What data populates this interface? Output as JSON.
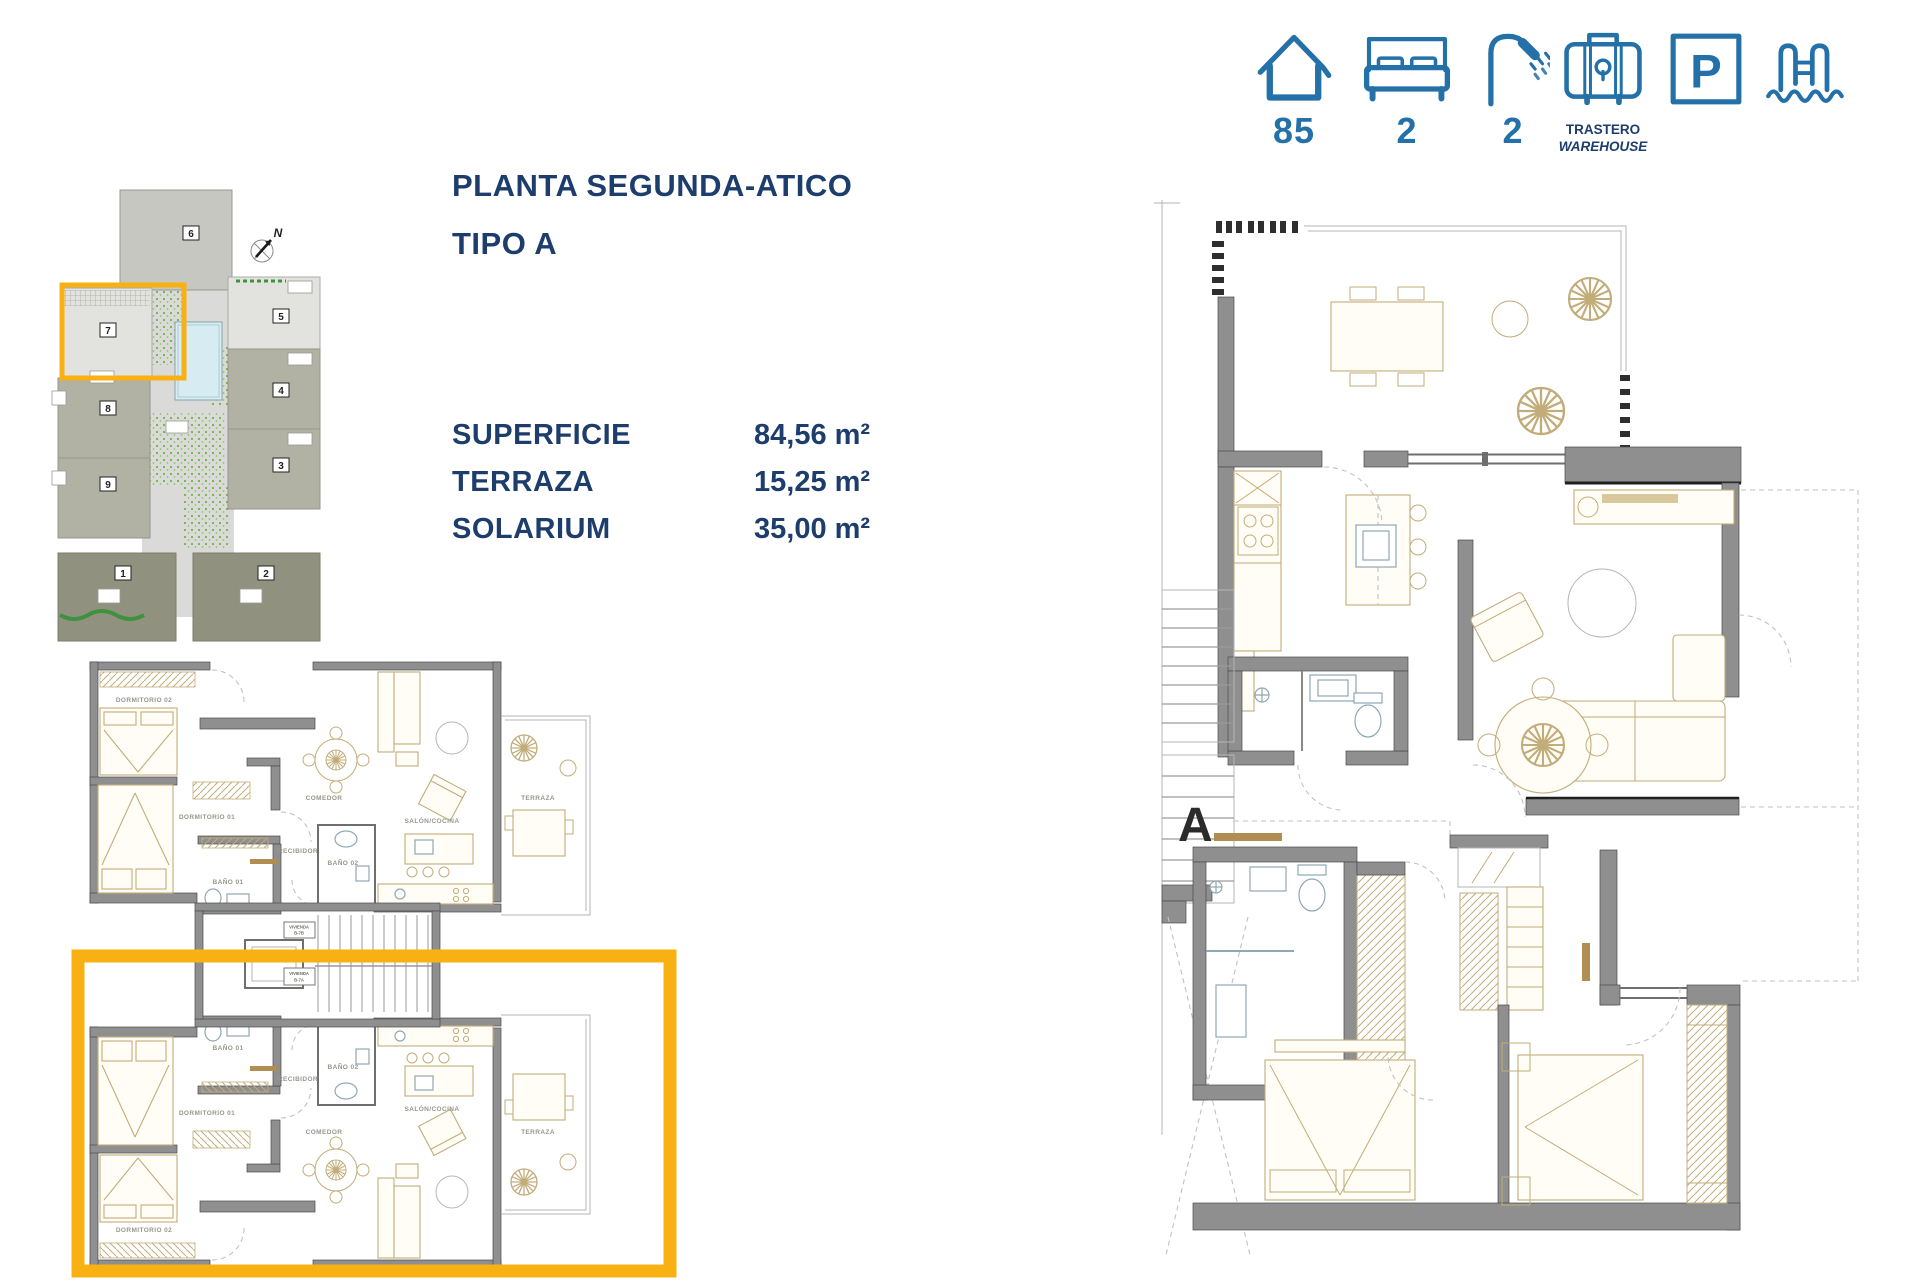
{
  "colors": {
    "accent_orange": "#f9b013",
    "icon_blue": "#2470a8",
    "navy": "#1d3e6c",
    "wall_gray": "#8f8f8f",
    "furniture_tan": "#c2ac79",
    "pool_blue": "#d6ecf2"
  },
  "amenities": {
    "surface": {
      "icon": "house-icon",
      "value": "85"
    },
    "bedrooms": {
      "icon": "bed-icon",
      "value": "2"
    },
    "bathrooms": {
      "icon": "shower-icon",
      "value": "2"
    },
    "storage": {
      "icon": "warehouse-icon",
      "line1": "TRASTERO",
      "line2": "WAREHOUSE"
    },
    "parking": {
      "icon": "parking-icon",
      "letter": "P"
    },
    "pool": {
      "icon": "pool-icon"
    }
  },
  "title": {
    "line1": "PLANTA SEGUNDA-ATICO",
    "line2": "TIPO A"
  },
  "specs": [
    {
      "label": "SUPERFICIE",
      "value": "84,56 m²"
    },
    {
      "label": "TERRAZA",
      "value": "15,25 m²"
    },
    {
      "label": "SOLARIUM",
      "value": "35,00 m²"
    }
  ],
  "siteplan": {
    "north": "N",
    "buildings": [
      "1",
      "2",
      "3",
      "4",
      "5",
      "6",
      "7",
      "8",
      "9"
    ]
  },
  "left_plan": {
    "room_labels": {
      "dormitorio02": "DORMITORIO 02",
      "dormitorio01": "DORMITORIO 01",
      "bano01": "BAÑO 01",
      "bano02": "BAÑO 02",
      "recibidor": "RECIBIDOR",
      "comedor": "COMEDOR",
      "salon": "SALÓN/COCINA",
      "terraza": "TERRAZA"
    },
    "stair_labels": [
      {
        "line1": "VIVIENDA",
        "line2": "B-7B"
      },
      {
        "line1": "VIVIENDA",
        "line2": "B-7A"
      }
    ]
  },
  "right_plan": {
    "section_label": "A"
  }
}
